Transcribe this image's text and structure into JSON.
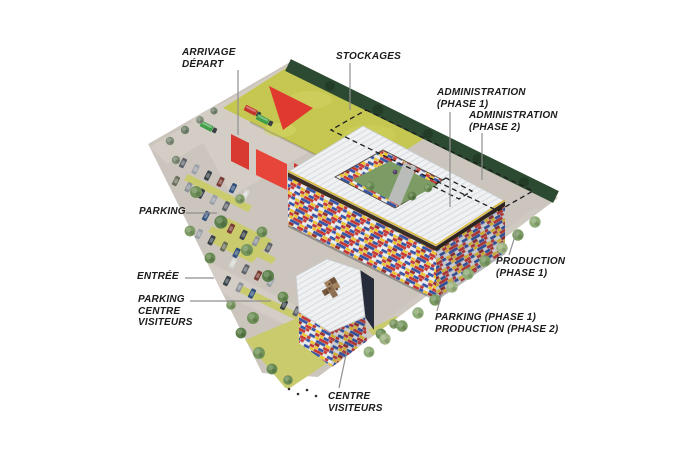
{
  "labels": {
    "arrivage_depart": "ARRIVAGE\nDÉPART",
    "stockages": "STOCKAGES",
    "administration_phase1": "ADMINISTRATION\n(PHASE 1)",
    "administration_phase2": "ADMINISTRATION\n(PHASE 2)",
    "parking": "PARKING",
    "entree": "ENTRÉE",
    "parking_centre_visiteurs": "PARKING\nCENTRE\nVISITEURS",
    "centre_visiteurs": "CENTRE\nVISITEURS",
    "production_phase1": "PRODUCTION\n(PHASE 1)",
    "parking_production": "PARKING (PHASE 1)\nPRODUCTION (PHASE 2)"
  },
  "colors": {
    "background": "#ffffff",
    "site_ground": "#cbc5bd",
    "road": "#d3cdc5",
    "lawn": "#c9cb6d",
    "stockage_roof": "#c5c751",
    "roof_white": "#eff1f3",
    "lego_red": "#cf3a33",
    "lego_blue": "#3756a5",
    "lego_yellow": "#edc431",
    "tree_band": "#2c4a31",
    "courtyard_green": "#7d9c65",
    "visitor_dark_facade": "#272c3a",
    "leader_line": "#8f8f8f",
    "label_text": "#1b1b1b"
  }
}
